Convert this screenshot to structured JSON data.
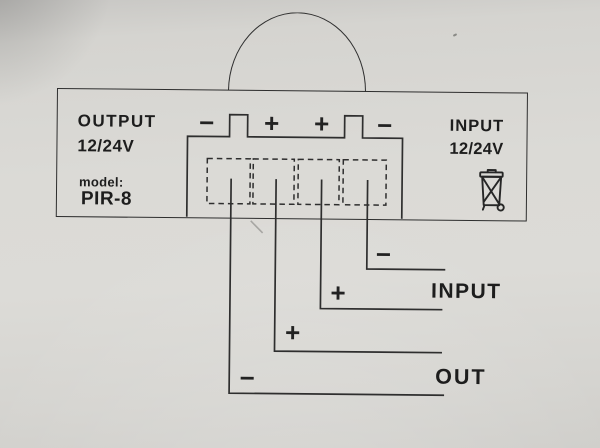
{
  "module": {
    "output_label": "OUTPUT",
    "output_voltage": "12/24V",
    "model_caption": "model:",
    "model_name": "PIR-8",
    "input_label": "INPUT",
    "input_voltage": "12/24V"
  },
  "terminals": {
    "signs": [
      "−",
      "+",
      "+",
      "−"
    ]
  },
  "wires": [
    {
      "sign": "−"
    },
    {
      "sign": "+"
    },
    {
      "sign": "+"
    },
    {
      "sign": "−"
    }
  ],
  "wire_labels": {
    "input": "INPUT",
    "out": "OUT"
  },
  "icons": {
    "weee": "crossed-out-wheelie-bin-icon"
  },
  "colors": {
    "paper": "#dbdad6",
    "line": "#2e2e2e",
    "text": "#1d1d1d"
  }
}
